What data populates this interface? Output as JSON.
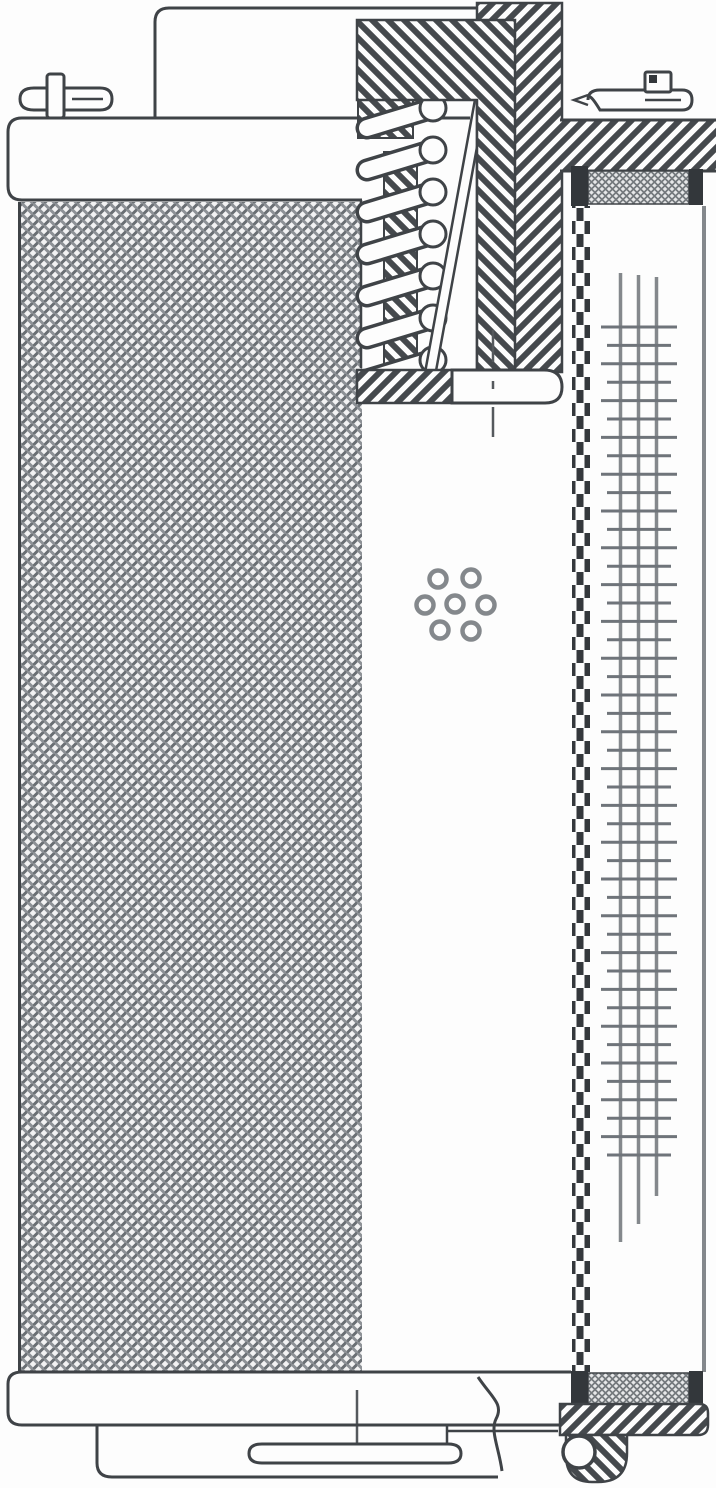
{
  "figure": {
    "title": "Filter element cross-section technical drawing",
    "description": "Patent-style line drawing of a cylindrical hydraulic filter cartridge shown in half section: woven mesh outer screen, top end cap with bypass spring, perforated center tube, pleated media column and bottom end cap with seal ring.",
    "width": 716,
    "height": 1488
  },
  "colors": {
    "background": "#fdfdfd",
    "line": "#3f4347",
    "gray_line": "#84888c",
    "tick_line": "#6f747a",
    "dark_fill": "#33373b",
    "hatch": "#45494d",
    "weave_dark": "#696e73",
    "weave_light": "#8d9196",
    "weave_bg": "#f2f2f3",
    "fine_bg": "#e7e8e9",
    "white": "#fdfdfd"
  },
  "diagram": {
    "spring": {
      "coil_count": 7,
      "cx": 433,
      "first_y": 108,
      "spacing": 42,
      "circle_r": 13,
      "body_dx": -66,
      "body_dy": 20,
      "body_outer_w": 23,
      "body_inner_w": 16
    },
    "perforations": {
      "cx": 455,
      "cy": 604,
      "hole_r": 8.5,
      "holes": [
        [
          0,
          0
        ],
        [
          31,
          1
        ],
        [
          -30,
          1
        ],
        [
          16,
          -26
        ],
        [
          -17,
          -25
        ],
        [
          16,
          27
        ],
        [
          -15,
          26
        ]
      ]
    },
    "pleats": {
      "vlines": [
        {
          "x": 620.5,
          "y1": 273,
          "y2": 1242
        },
        {
          "x": 638.5,
          "y1": 275,
          "y2": 1224
        },
        {
          "x": 656.5,
          "y1": 277,
          "y2": 1196
        }
      ],
      "ticks": {
        "y_start": 327,
        "spacing": 18.4,
        "count": 46,
        "long_x1": 601,
        "long_x2": 677,
        "short_x1": 607,
        "short_x2": 671
      }
    },
    "centerlines": [
      {
        "x": 493,
        "dashes": [
          [
            330,
            362
          ],
          [
            381,
            389
          ],
          [
            407,
            437
          ]
        ]
      },
      {
        "x": 357,
        "dashes": [
          [
            1390,
            1443
          ]
        ]
      }
    ],
    "seal_ring": {
      "cx": 579,
      "cy": 1452,
      "r": 16
    }
  }
}
